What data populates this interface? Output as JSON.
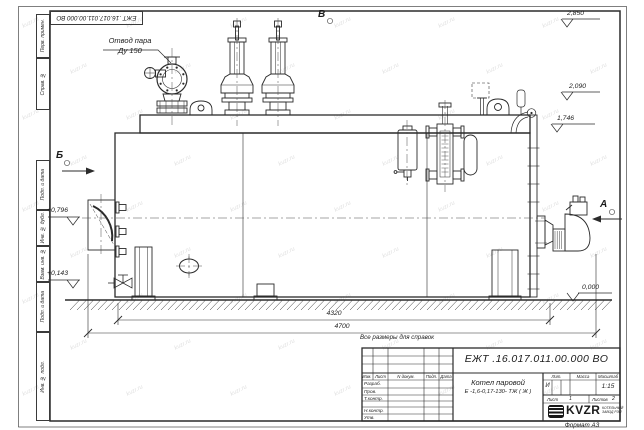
{
  "watermark": {
    "text": "kvzr.ru"
  },
  "sheet": {
    "stamp_top": "ЕЖТ .16.017.011.00.000  ВО",
    "format_note": "Формат А3",
    "frame_labels": [
      "Перв. примен.",
      "Справ. №",
      "Подп. и дата",
      "Инв. № дубл.",
      "Взам. инв. №",
      "Подп. и дата",
      "Инв. № подл."
    ]
  },
  "annotations": {
    "steam_outlet_line1": "Отвод пара",
    "steam_outlet_line2": "Ду 150",
    "view_top": "В",
    "view_left": "Б",
    "view_right": "А",
    "reference_note": "Все размеры для справок"
  },
  "elevations": {
    "top": "2,850",
    "upper": "2,090",
    "band": "1,746",
    "door": "+0,796",
    "lower": "+0,143",
    "ground": "0,000"
  },
  "dimensions": {
    "inner_length": "4320",
    "overall_length": "4700"
  },
  "title_block": {
    "designation": "ЕЖТ .16.017.011.00.000  ВО",
    "product_line1": "Котел паровой",
    "product_line2": "Е -1,6-0,17-130- ТЖ ( Ж )",
    "col_izm": "Изм.",
    "col_list": "Лист",
    "col_doc": "N докум.",
    "col_podp": "Подп.",
    "col_data": "Дата",
    "row_razrab": "Разраб.",
    "row_prov": "Пров.",
    "row_tkontr": "Т.контр.",
    "row_nkontr": "Н.контр.",
    "row_utv": "Утв.",
    "lit_header": "Лит.",
    "mass_header": "Масса",
    "scale_header": "Масштаб",
    "lit_value": "И",
    "scale_value": "1:15",
    "sheet_label": "Лист",
    "sheet_value": "1",
    "sheets_label": "Листов",
    "sheets_value": "2",
    "logo": "KVZR",
    "company_line1": "КОТЕЛЬНЫЙ",
    "company_line2": "ЗАВОД РЭП"
  }
}
